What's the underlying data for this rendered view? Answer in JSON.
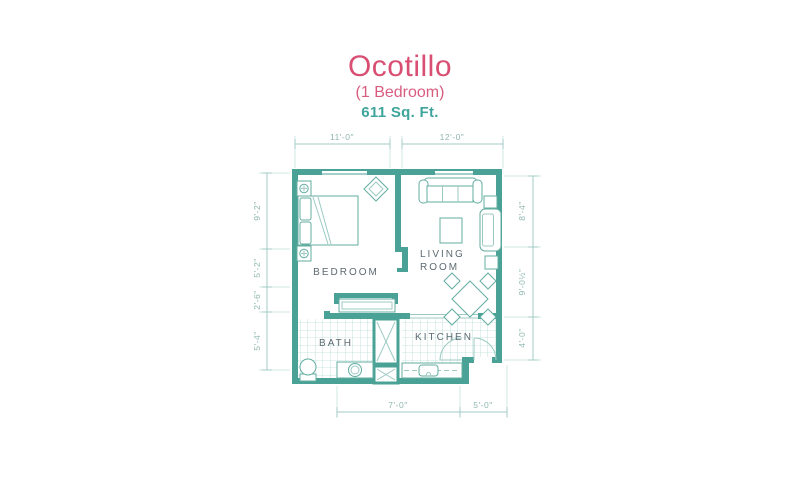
{
  "header": {
    "title": "Ocotillo",
    "subtitle": "(1 Bedroom)",
    "area": "611 Sq. Ft."
  },
  "rooms": {
    "bedroom": "BEDROOM",
    "living_line1": "LIVING",
    "living_line2": "ROOM",
    "bath": "BATH",
    "kitchen": "KITCHEN"
  },
  "dimensions": {
    "top": [
      "11'-0\"",
      "12'-0\""
    ],
    "left": [
      "9'-2\"",
      "5'-2\"",
      "2'-6\"",
      "5'-4\""
    ],
    "right": [
      "8'-4\"",
      "9'-0½\"",
      "4'-0\""
    ],
    "bottom": [
      "7'-0\"",
      "5'-0\""
    ]
  },
  "colors": {
    "accent_pink": "#d84f73",
    "accent_teal": "#3fa49c",
    "wall_teal": "#4aa296",
    "dimension_teal": "#8fb7b0",
    "label_gray": "#5d6a72"
  }
}
